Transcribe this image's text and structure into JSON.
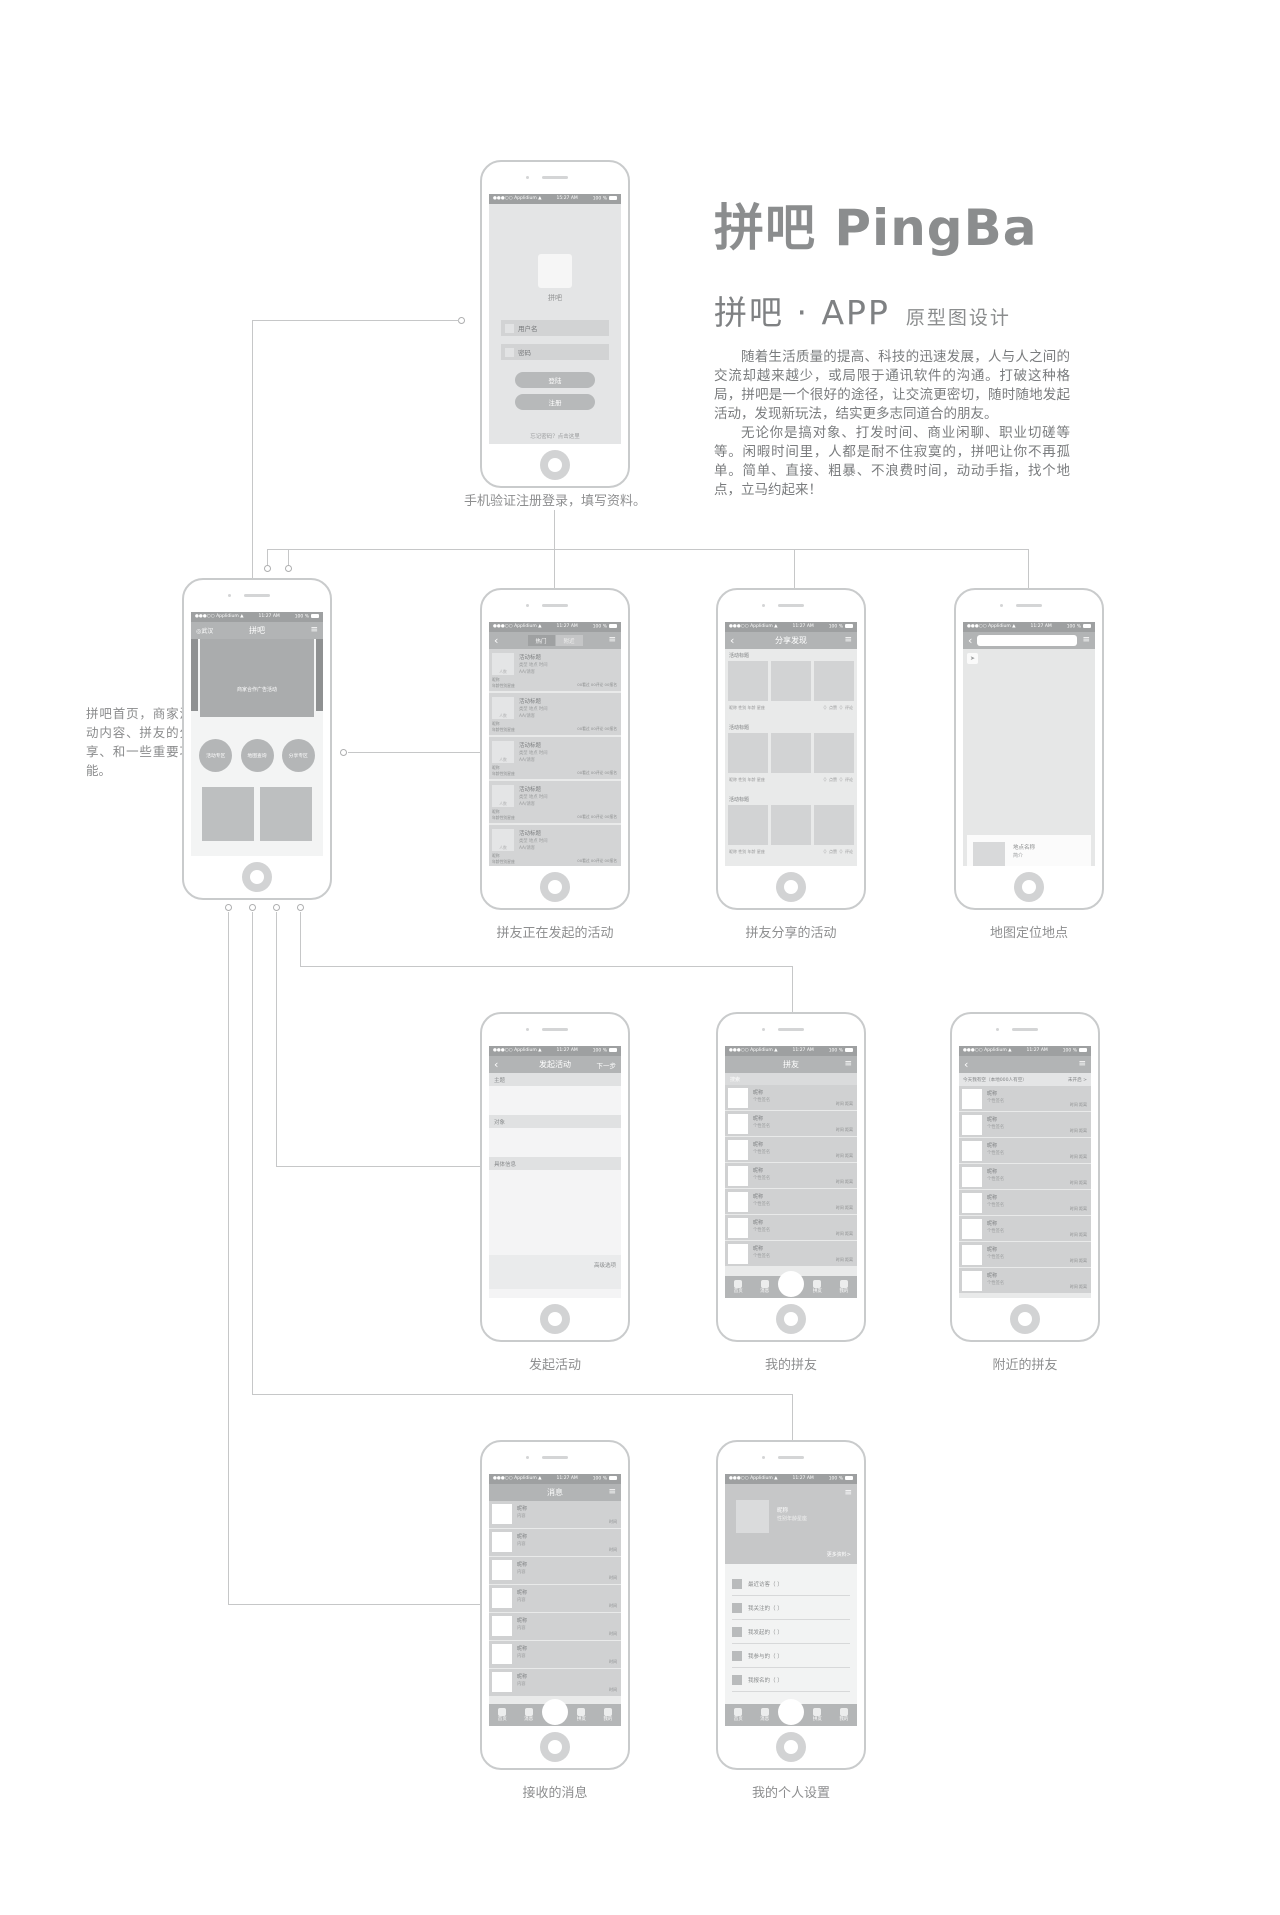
{
  "brand": {
    "logo": "拼吧 PingBa",
    "subtitle": "拼吧 · APP",
    "subtitle_note": "原型图设计",
    "intro1": "随着生活质量的提高、科技的迅速发展，人与人之间的交流却越来越少，或局限于通讯软件的沟通。打破这种格局，拼吧是一个很好的途径，让交流更密切，随时随地发起活动，发现新玩法，结实更多志同道合的朋友。",
    "intro2": "无论你是搞对象、打发时间、商业闲聊、职业切磋等等。闲暇时间里，人都是耐不住寂寞的，拼吧让你不再孤单。简单、直接、粗暴、不浪费时间，动动手指，找个地点，立马约起来！"
  },
  "status": {
    "carrier": "●●●○○ Applidium ▲",
    "time_login": "15:27 AM",
    "time": "11:27 AM",
    "battery": "100 %"
  },
  "icons": {
    "back": "‹",
    "menu": "≡",
    "location": "◎",
    "locate": "➤"
  },
  "captions": {
    "login": "手机验证注册登录，填写资料。",
    "home_note": "拼吧首页，商家活动内容、拼友的分享、和一些重要功能。",
    "activities": "拼友正在发起的活动",
    "share": "拼友分享的活动",
    "map": "地图定位地点",
    "create": "发起活动",
    "my_friends": "我的拼友",
    "nearby": "附近的拼友",
    "messages": "接收的消息",
    "profile": "我的个人设置"
  },
  "login": {
    "app_name": "拼吧",
    "username": "用户名",
    "password": "密码",
    "login_btn": "登陆",
    "register_btn": "注册",
    "forgot": "忘记密码？点击这里"
  },
  "home": {
    "location": "武汉",
    "title": "拼吧",
    "banner": "商家合作广告活动",
    "circles": [
      "活动专区",
      "地图查询",
      "分享专区"
    ]
  },
  "tabbar": [
    "首页",
    "消息",
    "拼友",
    "我的"
  ],
  "activities": {
    "tab_hot": "热门",
    "tab_nearby": "附近",
    "row": {
      "thumb": "人数",
      "title": "活动标题",
      "meta": "类型 地点 时间",
      "pay": "AA/请客",
      "nick": "昵称",
      "info": "年龄性别星座",
      "stats": "00看过 00评论 00报名"
    }
  },
  "share": {
    "title": "分享发现",
    "section": {
      "header": "活动标题",
      "owner": "昵称 性别 年龄 星座",
      "stats": "（）点赞（）评论"
    }
  },
  "map": {
    "card_name": "地点名称",
    "card_desc": "简介",
    "card_actions": "关注 评论 拼吧"
  },
  "create": {
    "title": "发起活动",
    "next": "下一步",
    "subject": "主题",
    "target": "对象",
    "detail": "具体信息",
    "advanced": "高级选项"
  },
  "friends": {
    "title": "拼友",
    "search": "搜索",
    "row": {
      "nick": "昵称",
      "sig": "个性签名",
      "meta": "时间 距离"
    }
  },
  "nearby": {
    "header": "今天我有空（本地000人有空）",
    "toggle": "未开启 >",
    "row": {
      "nick": "昵称",
      "sig": "个性签名",
      "meta": "时间 距离"
    }
  },
  "messages": {
    "title": "消息",
    "row": {
      "nick": "昵称",
      "content": "内容",
      "time": "时间"
    }
  },
  "profile": {
    "nick": "昵称",
    "info": "性别年龄星座",
    "more": "更多资料>",
    "menu": [
      "最近访客（ ）",
      "我关注的（ ）",
      "我发起的（ ）",
      "我参与的（ ）",
      "我报名的（ ）"
    ]
  }
}
